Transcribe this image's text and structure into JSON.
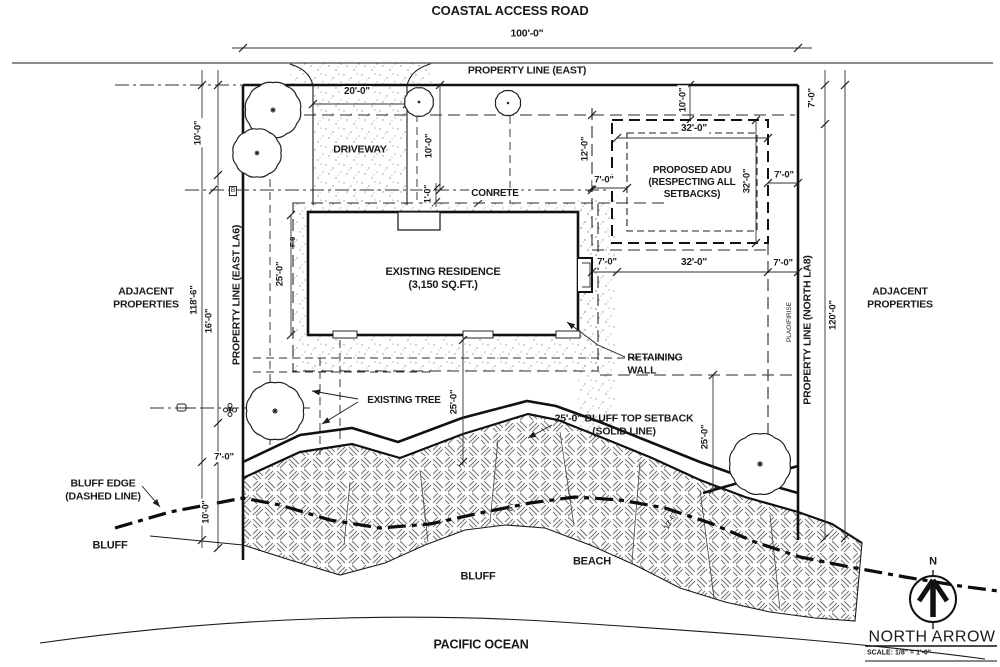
{
  "titles": {
    "road": "COASTAL ACCESS ROAD",
    "ocean": "PACIFIC OCEAN"
  },
  "areas": {
    "driveway": "DRIVEWAY",
    "residence": "EXISTING RESIDENCE\n(3,150 SQ.FT.)",
    "adu": "PROPOSED ADU\n(RESPECTING ALL\nSETBACKS)",
    "concrete": "CONRETE",
    "retaining_wall": "RETAINING\nWALL",
    "existing_tree": "EXISTING TREE",
    "bluff_setback": "25'-0\" BLUFF TOP SETBACK\n(SOLID LINE)",
    "bluff_edge": "BLUFF EDGE\n(DASHED LINE)",
    "bluff_left": "BLUFF",
    "bluff_mid": "BLUFF",
    "beach": "BEACH",
    "adjacent_left": "ADJACENT\nPROPERTIES",
    "adjacent_right": "ADJACENT\nPROPERTIES"
  },
  "property_lines": {
    "east_top": "PROPERTY LINE (EAST)",
    "east_side": "PROPERTY LINE (EAST LA6)",
    "north_side": "PROPERTY LINE (NORTH LA8)"
  },
  "dims": {
    "lot_width": "100'-0\"",
    "driveway_width": "20'-0\"",
    "front_setback_left": "10'-0\"",
    "driveway_side": "10'-0\"",
    "one_foot": "1'-0\"",
    "adu_top_offset": "10'-0\"",
    "corner_right_top": "7'-0\"",
    "adu_width_top": "32'-0\"",
    "adu_left_gap": "12'-0\"",
    "adu_side_left": "7'-0\"",
    "adu_depth_right": "32'-0\"",
    "adu_side_right": "7'-0\"",
    "below_left": "7'-0\"",
    "below_width": "32'-0\"",
    "below_right": "7'-0\"",
    "residence_side": "25'-0\"",
    "lot_depth_left": "118'-6\"",
    "sixteen": "16'-0\"",
    "mid_25": "25'-0\"",
    "right_25": "25'-0\"",
    "seven_bottom_left": "7'-0\"",
    "ten_bottom_left": "10'-0\"",
    "lot_depth_right": "120'-0\""
  },
  "garbled": {
    "right_pl_text": "PLAOIFIRISE",
    "hatch_a": "BY",
    "hatch_b": "12'-6\"",
    "near_residence": "F-9",
    "b_symbol": "B"
  },
  "north": {
    "n": "N",
    "label": "NORTH ARROW",
    "scale": "SCALE: 1/8\" = 1'-0\""
  }
}
